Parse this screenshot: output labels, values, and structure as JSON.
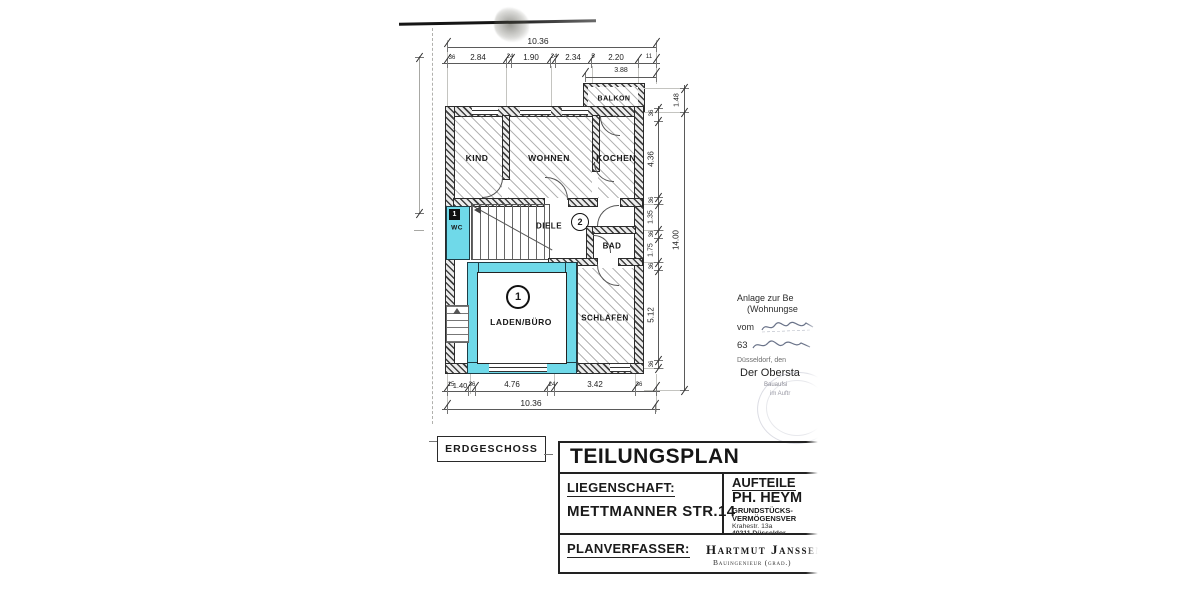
{
  "plan": {
    "floor_label": "ERDGESCHOSS",
    "rooms": {
      "kind": "KIND",
      "wohnen": "WOHNEN",
      "kochen": "KOCHEN",
      "balkon": "BALKON",
      "wc": "WC",
      "diele": "DIELE",
      "bad": "BAD",
      "laden": "LADEN/BÜRO",
      "schlafen": "SCHLAFEN"
    },
    "unit_markers": {
      "laden": "1",
      "diele": "2",
      "wc_tag": "1"
    }
  },
  "dims": {
    "top_total": "10.36",
    "top_segments": [
      "2.84",
      "1.90",
      "2.34",
      "2.20"
    ],
    "top_small": [
      "36",
      "24",
      "24",
      "5",
      "11"
    ],
    "balcony_width": "3.88",
    "right_segments": [
      "1.48",
      "4.36",
      "1.35",
      "1.75",
      "5.12"
    ],
    "right_small": [
      "36",
      "36",
      "36",
      "36",
      "36"
    ],
    "right_total": "14.00",
    "bottom_segments": [
      "1.40",
      "4.76",
      "3.42"
    ],
    "bottom_small": [
      "15",
      "36",
      "24",
      "36"
    ],
    "bottom_total": "10.36"
  },
  "title_block": {
    "title": "TEILUNGSPLAN",
    "liegenschaft_label": "LIEGENSCHAFT:",
    "liegenschaft_value": "METTMANNER STR.14",
    "aufteiler_label": "AUFTEILE",
    "aufteiler_name": "PH. HEYM",
    "aufteiler_desc1": "GRUNDSTÜCKS-",
    "aufteiler_desc2": "VERMÖGENSVER",
    "aufteiler_addr1": "Krahestr. 13a",
    "aufteiler_addr2": "40211 Düsseldor",
    "planverfasser_label": "PLANVERFASSER:",
    "planverfasser_name": "Hartmut Janssen",
    "planverfasser_title": "Bauingenieur (grad.)"
  },
  "annotation": {
    "line1": "Anlage zur Be",
    "line2": "(Wohnungse",
    "vom_label": "vom",
    "number": "63",
    "date_line": "Düsseldorf, den",
    "official": "Der Obersta",
    "stamp_small1": "Bauaufsi",
    "stamp_small2": "im Auftr"
  },
  "colors": {
    "highlight": "#6fd9e9",
    "line": "#333333"
  }
}
